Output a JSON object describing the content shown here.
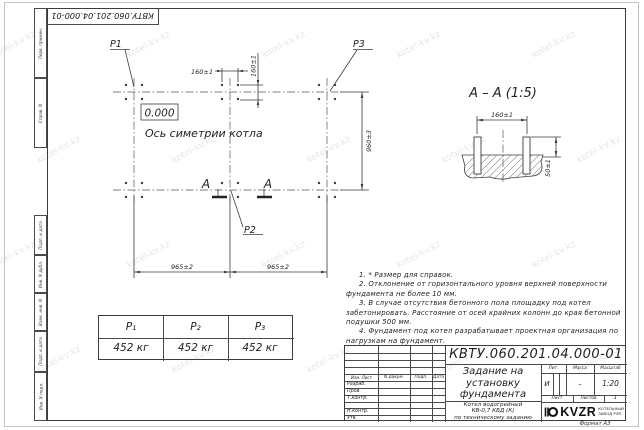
{
  "watermark": "kotel-kv.kz",
  "top_stamp": "КВТУ.060.201.04.000-01 Ф",
  "margin_labels": [
    "Перв. примен.",
    "Справ. N",
    "Подп. и дата",
    "Инв. N дубл.",
    "Взам. инв. N",
    "Подп. и дата",
    "Инв. N подл."
  ],
  "plan": {
    "p1": "P1",
    "p2": "P2",
    "p3": "P3",
    "elevation": "0.000",
    "axis_label": "Ось симетрии котла",
    "dim_160_h": "160±1",
    "dim_160_v": "160±1",
    "dim_965_left": "965±2",
    "dim_965_right": "965±2",
    "dim_960": "960±3",
    "section_letter": "A"
  },
  "section": {
    "title": "А – А (1:5)",
    "dim_160": "160±1",
    "dim_50": "50±1"
  },
  "load_table": {
    "headers": [
      "P₁",
      "P₂",
      "P₃"
    ],
    "values": [
      "452 кг",
      "452 кг",
      "452 кг"
    ]
  },
  "notes": [
    "1. * Размер для справок.",
    "2. Отклонение от горизонтального уровня верхней поверхности фундамента не более 10 мм.",
    "3. В случае отсутствия бетонного пола площадку под котел забетонировать. Расстояние от осей крайних колонн до края бетонной подушки 500 мм.",
    "4. Фундамент под котел разрабатывает проектная организация по нагрузкам на фундамент."
  ],
  "title_block": {
    "doc_number": "КВТУ.060.201.04.000-01 Ф",
    "title": "Задание на установку фундамента",
    "product_line1": "Котел водогрейный",
    "product_line2": "КВ-0,7 КБД (К)",
    "product_line3": "по техническому заданию",
    "col_headers": [
      "Изм. Лист",
      "N докум.",
      "Подп.",
      "Дата"
    ],
    "row_labels": [
      "Разраб.",
      "Пров.",
      "Т.контр.",
      "",
      "Н.контр.",
      "Утв."
    ],
    "lit_label": "Лит.",
    "mass_label": "Масса",
    "scale_label": "Масштаб",
    "lit_value": "И",
    "mass_value": "–",
    "scale_value": "1:20",
    "sheet_label": "Лист",
    "sheets_label": "Листов",
    "sheets_value": "1",
    "logo_text": "KVZR",
    "logo_sub1": "КОТЕЛЬНЫЙ",
    "logo_sub2": "ЗАВОД РЭП",
    "format_label": "Формат А3"
  }
}
